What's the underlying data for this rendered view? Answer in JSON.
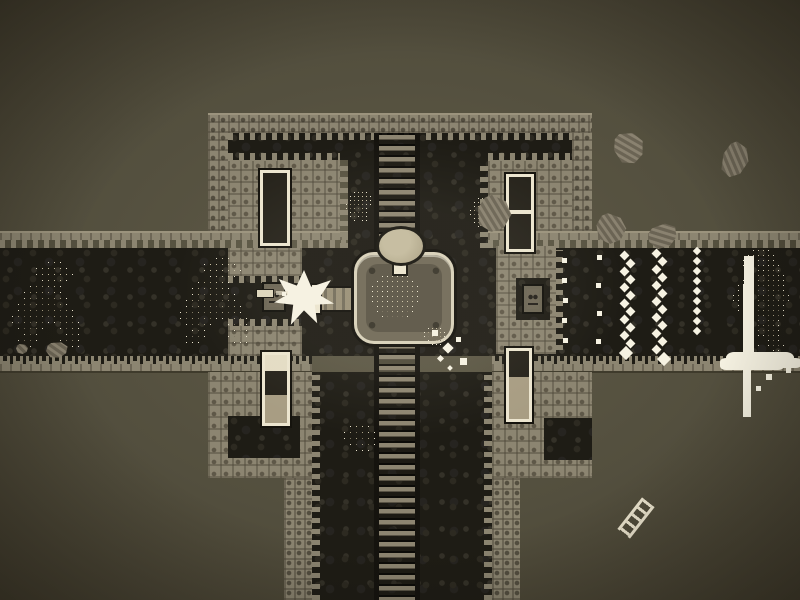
{
  "app": {
    "name": "sepia-pixel-dungeon-defense",
    "type": "game-screenshot"
  },
  "palette": {
    "bg": "#534f3e",
    "bg_dark": "#453f2f",
    "bg_light": "#605b48",
    "wall": "#8c8571",
    "wall_light": "#9b937d",
    "wall_shade": "#6b6554",
    "wall_line": "#565040",
    "dark": "#1e1c15",
    "cobble_a": "#2d2a21",
    "cobble_b": "#262420",
    "cobble_c": "#343128",
    "cream": "#ece5cf",
    "white": "#f6f2e2",
    "spr_light": "#cbc2a5",
    "spr_mid": "#a89e82",
    "spr_dark": "#7b7360",
    "rung": "#8d8571",
    "rail": "#15130e",
    "door_dark": "#26231b",
    "door_lit": "#e3dcc4",
    "door_tan": "#a89d83"
  },
  "scene": {
    "viewport": {
      "width": 800,
      "height": 600
    },
    "player": {
      "pedestal": {
        "x": 354,
        "y": 252,
        "w": 100,
        "h": 92
      },
      "head": {
        "x": 376,
        "y": 226,
        "w": 50,
        "h": 40
      },
      "neck": {
        "x": 392,
        "y": 262,
        "w": 16,
        "h": 14
      },
      "cannon": {
        "x": 316,
        "y": 286,
        "w": 42,
        "h": 26
      },
      "cannon_tip": {
        "x": 310,
        "y": 283,
        "w": 12,
        "h": 32
      },
      "pilot": {
        "x": 372,
        "y": 276,
        "cell": 5
      },
      "facing": "left"
    },
    "muzzle_flash": {
      "x": 274,
      "y": 270,
      "w": 60,
      "h": 56
    },
    "projectile": {
      "x": 256,
      "y": 289,
      "w": 18,
      "h": 9,
      "trail": {
        "x": 276,
        "y": 291,
        "w": 12,
        "h": 4
      }
    },
    "enemies": {
      "walkers": [
        {
          "x": 12,
          "y": 262,
          "cell": 6
        },
        {
          "x": 180,
          "y": 258,
          "cell": 6
        }
      ],
      "climbers": [
        {
          "x": 346,
          "y": 192,
          "cell": 4
        },
        {
          "x": 470,
          "y": 198,
          "cell": 4
        }
      ],
      "blobs": [
        {
          "x": 424,
          "y": 328,
          "cell": 4
        },
        {
          "x": 344,
          "y": 426,
          "cell": 6
        }
      ],
      "boss": {
        "x": 733,
        "y": 250,
        "cell": 5
      }
    },
    "milk": {
      "stream": {
        "x": 744,
        "y": 256,
        "w": 10,
        "h": 102
      },
      "puddle": {
        "x": 726,
        "y": 352,
        "w": 68,
        "h": 16
      },
      "drips": [
        {
          "x": 766,
          "y": 374,
          "s": 6
        },
        {
          "x": 756,
          "y": 386,
          "s": 5
        },
        {
          "x": 786,
          "y": 368,
          "s": 5
        }
      ]
    },
    "chains": [
      {
        "x": 620,
        "y": 252,
        "count": 13,
        "spacing": 8,
        "size": 7,
        "zigzag": true
      },
      {
        "x": 652,
        "y": 250,
        "count": 14,
        "spacing": 8,
        "size": 7,
        "zigzag": true
      },
      {
        "x": 690,
        "y": 248,
        "count": 9,
        "spacing": 10,
        "size": 6,
        "zigzag": false
      }
    ],
    "dots": [
      {
        "x": 562,
        "y": 258
      },
      {
        "x": 562,
        "y": 278
      },
      {
        "x": 563,
        "y": 298
      },
      {
        "x": 562,
        "y": 318
      },
      {
        "x": 563,
        "y": 338
      },
      {
        "x": 597,
        "y": 255
      },
      {
        "x": 596,
        "y": 283
      },
      {
        "x": 597,
        "y": 311
      },
      {
        "x": 596,
        "y": 339
      }
    ],
    "sparks": [
      {
        "x": 432,
        "y": 330,
        "s": 6
      },
      {
        "x": 444,
        "y": 344,
        "s": 8
      },
      {
        "x": 456,
        "y": 337,
        "s": 5
      },
      {
        "x": 438,
        "y": 356,
        "s": 5
      },
      {
        "x": 460,
        "y": 358,
        "s": 7
      },
      {
        "x": 448,
        "y": 366,
        "s": 4
      },
      {
        "x": 282,
        "y": 292,
        "s": 4
      },
      {
        "x": 294,
        "y": 286,
        "s": 3
      }
    ],
    "debris": [
      {
        "x": 614,
        "y": 132,
        "w": 30,
        "h": 32,
        "rot": -15
      },
      {
        "x": 722,
        "y": 142,
        "w": 26,
        "h": 36,
        "rot": 22
      },
      {
        "x": 596,
        "y": 214,
        "w": 30,
        "h": 30,
        "rot": 10
      },
      {
        "x": 648,
        "y": 224,
        "w": 30,
        "h": 24,
        "rot": -28
      },
      {
        "x": 477,
        "y": 196,
        "w": 34,
        "h": 36,
        "rot": 14
      },
      {
        "x": 16,
        "y": 344,
        "w": 12,
        "h": 10,
        "rot": 0
      },
      {
        "x": 46,
        "y": 342,
        "w": 22,
        "h": 16,
        "rot": -10
      }
    ],
    "ladder_fragment": {
      "x": 628,
      "y": 498,
      "w": 16,
      "h": 40,
      "rot": 38
    }
  }
}
